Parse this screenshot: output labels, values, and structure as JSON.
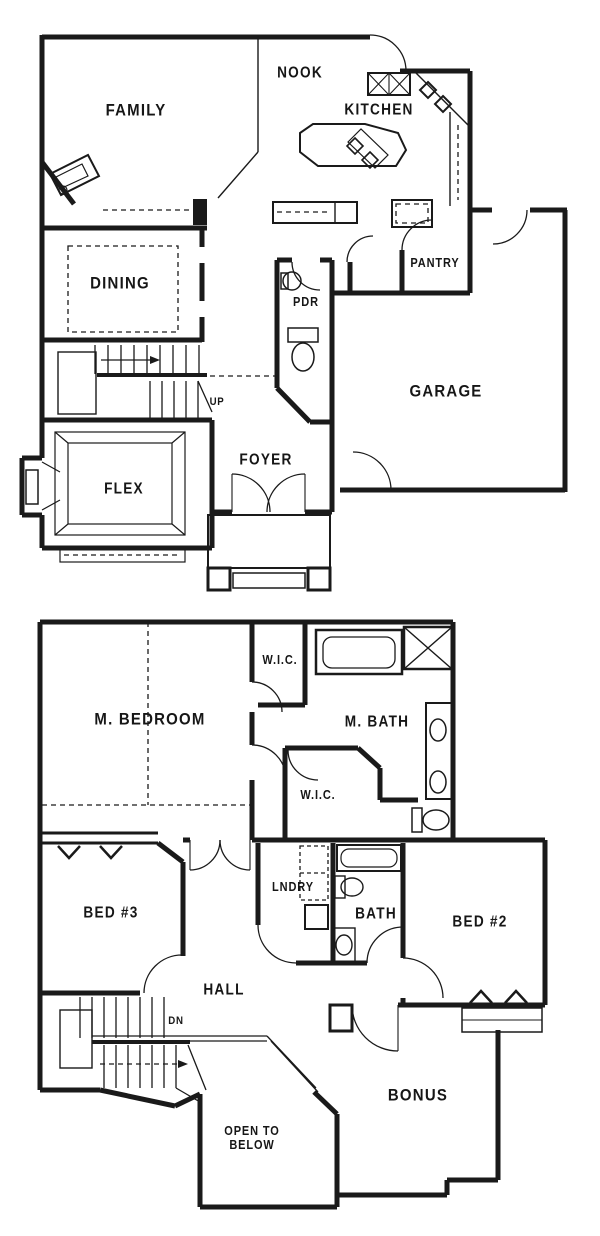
{
  "colors": {
    "background": "#ffffff",
    "ink": "#1a1a1a"
  },
  "labels": {
    "f1": {
      "family": "FAMILY",
      "nook": "NOOK",
      "kitchen": "KITCHEN",
      "dining": "DINING",
      "pdr": "PDR",
      "pantry": "PANTRY",
      "garage": "GARAGE",
      "up": "UP",
      "foyer": "FOYER",
      "flex": "FLEX"
    },
    "f2": {
      "m_bedroom": "M. BEDROOM",
      "wic1": "W.I.C.",
      "m_bath": "M. BATH",
      "wic2": "W.I.C.",
      "bed3": "BED #3",
      "lndry": "LNDRY",
      "bath": "BATH",
      "bed2": "BED #2",
      "hall": "HALL",
      "dn": "DN",
      "open_below": "OPEN TO\nBELOW",
      "bonus": "BONUS"
    }
  }
}
